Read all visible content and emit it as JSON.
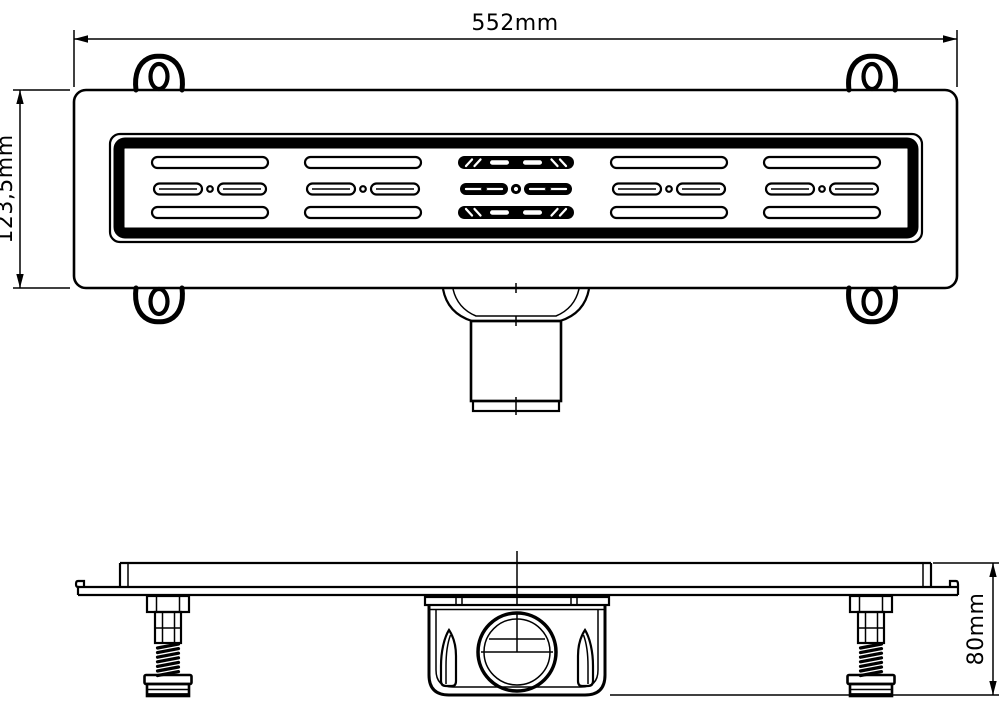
{
  "drawing": {
    "dimensions": {
      "top_width": {
        "label": "552mm"
      },
      "left_height": {
        "label": "123,5mm"
      },
      "side_height": {
        "label": "80mm"
      }
    },
    "colors": {
      "line_color": "#000000",
      "background": "#ffffff"
    }
  }
}
